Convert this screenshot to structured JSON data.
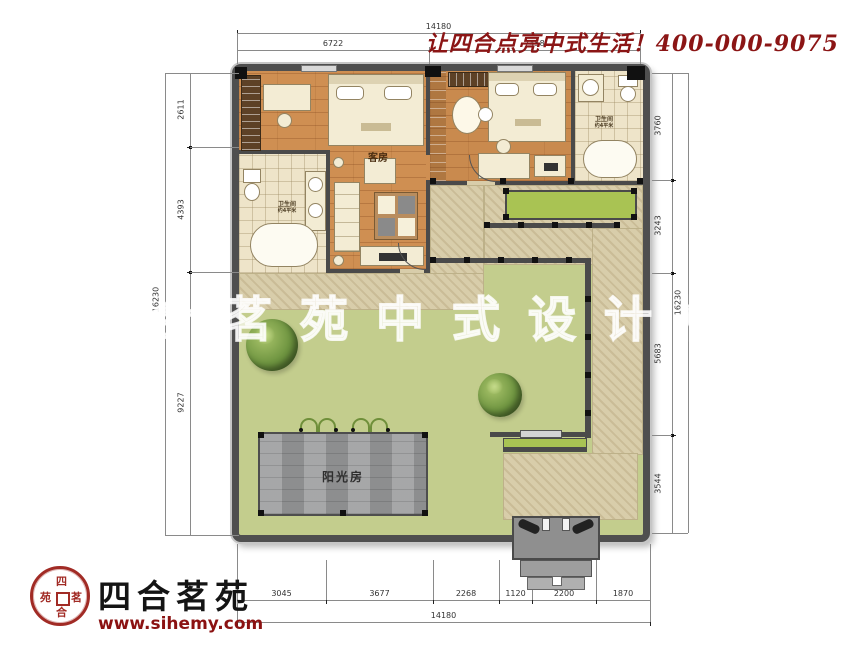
{
  "header": {
    "slogan": "让四合点亮中式生活！400-000-9075"
  },
  "watermark": "四合茗苑中式设计机构",
  "logo": {
    "brand": "四合茗苑",
    "url": "www.sihemy.com",
    "seal": {
      "top": "四",
      "left": "苑",
      "right": "茗",
      "bottom": "合"
    }
  },
  "rooms": {
    "guest": "客房",
    "bath_left": "卫生间",
    "bath_left_sub": "约4平米",
    "bath_right": "卫生间",
    "bath_right_sub": "约4平米",
    "sunroom": "阳光房"
  },
  "dims": {
    "top_total": "14180",
    "top_seg1": "6722",
    "top_seg2": "7458",
    "left_seg1": "2611",
    "left_seg2": "4393",
    "left_seg3": "9227",
    "left_total": "16230",
    "right_seg1": "3760",
    "right_seg2": "3243",
    "right_seg3": "5683",
    "right_seg4": "3544",
    "right_total": "16230",
    "bottom_seg1": "3045",
    "bottom_seg2": "3677",
    "bottom_seg3": "2268",
    "bottom_seg4": "1120",
    "bottom_seg5": "2200",
    "bottom_seg6": "1870",
    "bottom_total": "14180"
  },
  "colors": {
    "lawn": "#c3cd8d",
    "path": "#d8cdaa",
    "wall": "#4a4a4a",
    "wood": "#cf8f52",
    "tile": "#eee4c9",
    "sunroom_gray": "#98999a",
    "brand_red": "#8b1414"
  }
}
